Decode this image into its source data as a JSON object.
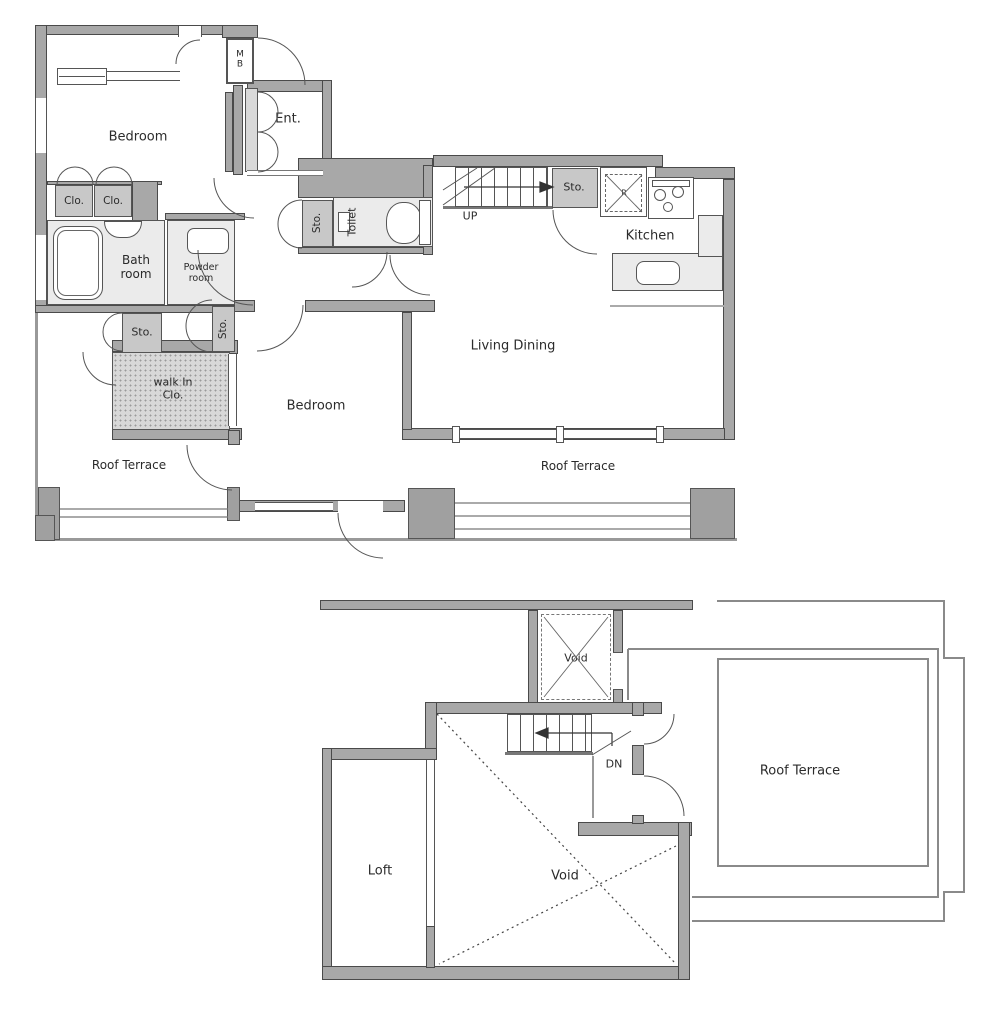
{
  "title": "Maisonette floor plan",
  "colors": {
    "wall": "#a8a8a8",
    "wall_edge": "#4a4a4a",
    "room_light": "#ebebeb",
    "closet": "#c8c8c8",
    "walk_in_closet": "#d8d8d8",
    "line": "#555555",
    "railing": "#777777",
    "text": "#2b2b2b"
  },
  "plan1": {
    "name": "main-floor",
    "labels": {
      "mb": "M\nB",
      "ent": "Ent.",
      "bedroom_top": "Bedroom",
      "clo_a": "Clo.",
      "clo_b": "Clo.",
      "bath": "Bath\nroom",
      "powder": "Powder\nroom",
      "sto_hall": "Sto.",
      "toilet": "Toilet",
      "up": "UP",
      "sto_stairs": "Sto.",
      "fridge": "R",
      "kitchen": "Kitchen",
      "living_dining": "Living Dining",
      "sto_left": "Sto.",
      "sto_side": "Sto.",
      "walk_in_closet": "walk In\nClo.",
      "bedroom_lower": "Bedroom",
      "terrace_left": "Roof Terrace",
      "terrace_south": "Roof Terrace"
    }
  },
  "plan2": {
    "name": "loft-floor",
    "labels": {
      "void_shaft": "Void",
      "down": "DN",
      "terrace": "Roof Terrace",
      "loft": "Loft",
      "void_main": "Void"
    }
  }
}
